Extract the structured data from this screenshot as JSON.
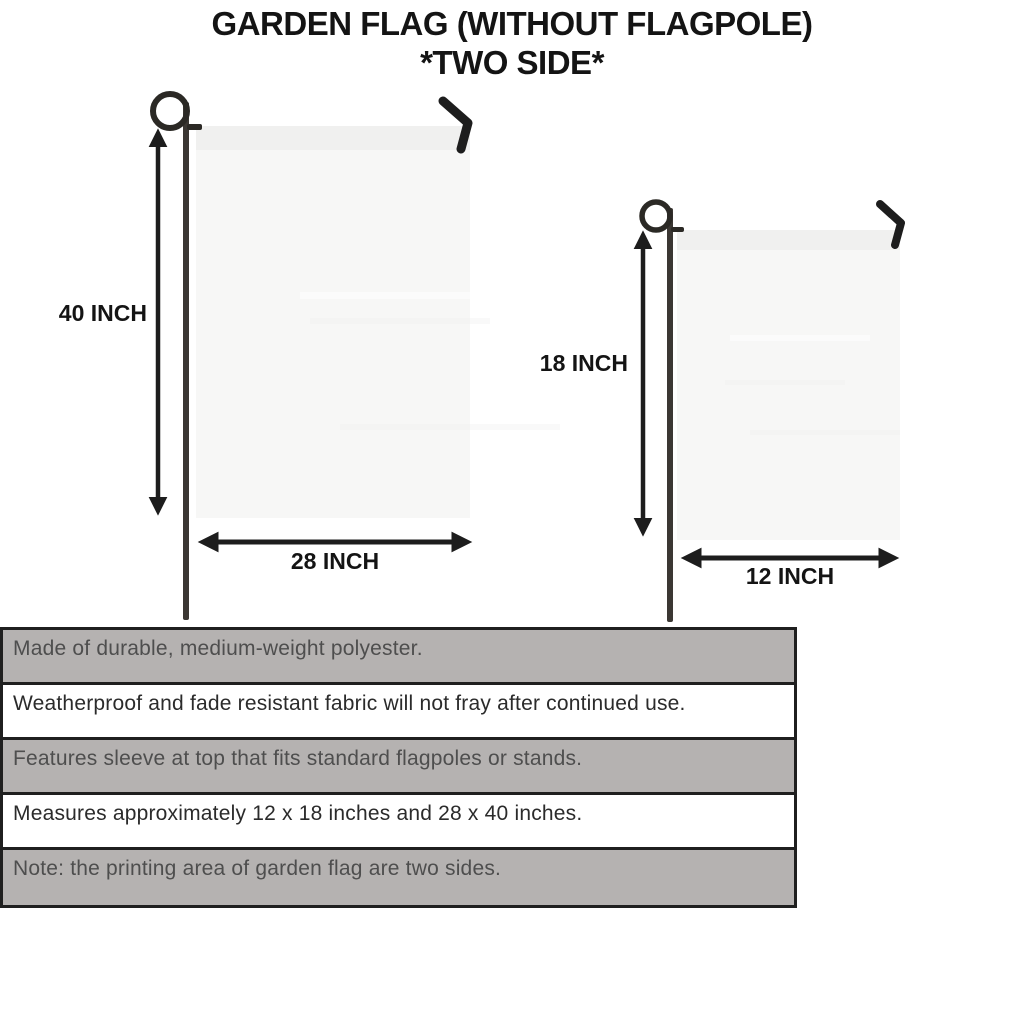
{
  "title": {
    "line1": "GARDEN FLAG (WITHOUT FLAGPOLE)",
    "line2": "*TWO SIDE*"
  },
  "large_flag": {
    "height_label": "40 INCH",
    "width_label": "28 INCH"
  },
  "small_flag": {
    "height_label": "18 INCH",
    "width_label": "12 INCH"
  },
  "specs": [
    "Made of durable, medium-weight polyester.",
    "Weatherproof and fade resistant fabric will not fray after continued use.",
    "Features sleeve at top that fits standard flagpoles or stands.",
    "Measures approximately 12 x 18 inches and 28 x 40 inches.",
    "Note: the printing area of garden flag are two sides."
  ],
  "colors": {
    "stripe_gray": "#b5b2b1",
    "table_border": "#1f1f1f",
    "flag_fill": "#f7f7f6",
    "flag_sleeve": "#f0f0ef",
    "pole": "#3b3733",
    "loop": "#2b2925",
    "arrow": "#1d1d1d",
    "title_text": "#141414"
  }
}
